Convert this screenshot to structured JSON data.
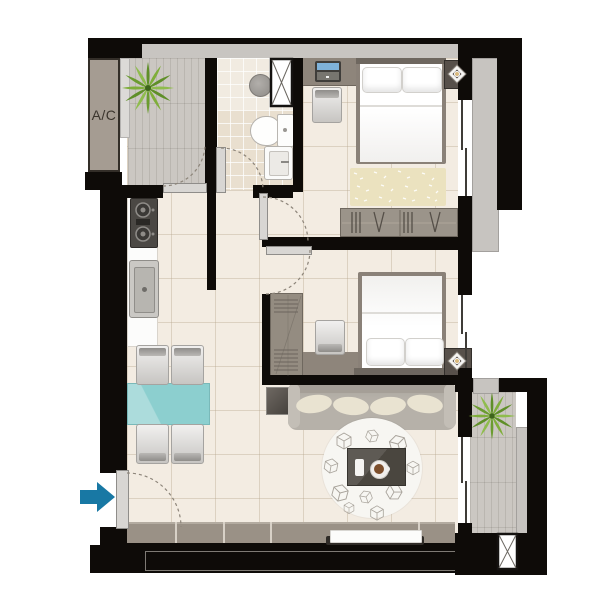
{
  "floorplan": {
    "ac_label": "A/C",
    "rooms": [
      "balcony-top",
      "bathroom",
      "bedroom-1",
      "bedroom-2",
      "kitchen-living-dining",
      "balcony-bottom",
      "entry"
    ],
    "colors": {
      "wall": "#0e0b08",
      "floor": "#f3ece2",
      "bathroom_tile": "#e9dfcf",
      "balcony_deck": "#cbc7c2",
      "sill_gray": "#c7c4c0",
      "furniture_taupe": "#8e857b",
      "wardrobe_gray": "#9b948a",
      "dining_table_teal": "#8ccfcf",
      "sofa_gray": "#b6b1a9",
      "cushion_cream": "#e9e3d1",
      "bed_rug_beige": "#ebe2bf",
      "entry_arrow_blue": "#1878a4",
      "plant_green": "#5f8f28",
      "lamp_gold": "#d9b97e"
    },
    "icons": {
      "entry_arrow": "arrow-right",
      "shaft": "x-cross-box",
      "plant": "top-view-plant",
      "nightstand_lamp": "concentric-diamond-lamp",
      "wardrobe_hangers": "hanger-ticks",
      "door_swing": "dashed-quarter-arc"
    }
  }
}
